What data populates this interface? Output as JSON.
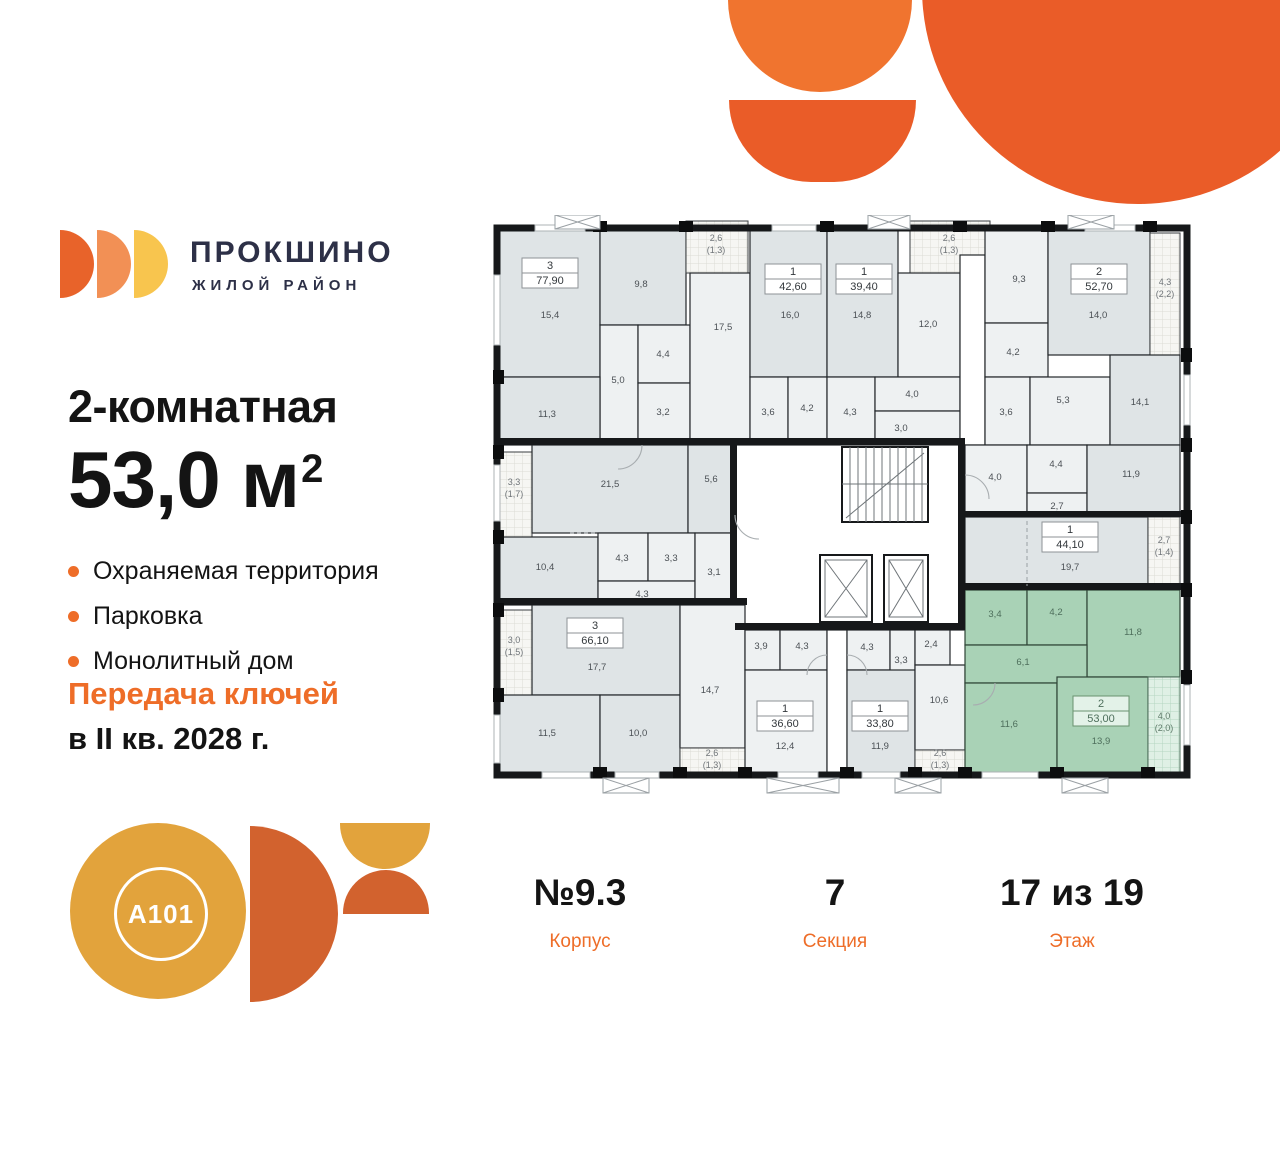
{
  "colors": {
    "orange": "#ea5c28",
    "orange_light": "#f0742f",
    "orange_mid": "#f29055",
    "yellow": "#f8c54e",
    "amber": "#e2a33c",
    "rust": "#d2622e",
    "navy": "#2d3047",
    "text_dark": "#141414",
    "accent": "#ee6d28",
    "room_green": "#a9d2b6",
    "room_gray": "#dfe4e6"
  },
  "brand": {
    "title": "ПРОКШИНО",
    "subtitle": "ЖИЛОЙ РАЙОН"
  },
  "offer": {
    "rooms_line": "2-комнатная",
    "area_value": "53,0 м",
    "area_sup": "2",
    "features": [
      "Охраняемая территория",
      "Парковка",
      "Монолитный дом"
    ],
    "keys_line1": "Передача ключей",
    "keys_line2": "в II кв. 2028 г."
  },
  "a101": {
    "logo_text": "A101"
  },
  "stats": [
    {
      "value": "№9.3",
      "label": "Корпус"
    },
    {
      "value": "7",
      "label": "Секция"
    },
    {
      "value": "17 из 19",
      "label": "Этаж"
    }
  ],
  "plan": {
    "highlighted_apartment": {
      "type": "2",
      "area": "53,00"
    },
    "apartments": [
      {
        "type": "3",
        "area": "77,90",
        "x": 60,
        "y": 58
      },
      {
        "type": "1",
        "area": "42,60",
        "x": 303,
        "y": 64
      },
      {
        "type": "1",
        "area": "39,40",
        "x": 374,
        "y": 64
      },
      {
        "type": "2",
        "area": "52,70",
        "x": 609,
        "y": 64
      },
      {
        "type": "1",
        "area": "44,10",
        "x": 580,
        "y": 322
      },
      {
        "type": "3",
        "area": "66,10",
        "x": 105,
        "y": 418
      },
      {
        "type": "1",
        "area": "36,60",
        "x": 295,
        "y": 501
      },
      {
        "type": "1",
        "area": "33,80",
        "x": 390,
        "y": 501
      },
      {
        "type": "2",
        "area": "53,00",
        "x": 611,
        "y": 496,
        "green": true
      }
    ],
    "room_labels": [
      {
        "t": "15,4",
        "x": 60,
        "y": 103
      },
      {
        "t": "9,8",
        "x": 151,
        "y": 72
      },
      {
        "t": "5,0",
        "x": 128,
        "y": 168
      },
      {
        "t": "4,4",
        "x": 173,
        "y": 142
      },
      {
        "t": "3,2",
        "x": 173,
        "y": 200
      },
      {
        "t": "11,3",
        "x": 57,
        "y": 202
      },
      {
        "t": "17,5",
        "x": 233,
        "y": 115
      },
      {
        "t": "16,0",
        "x": 300,
        "y": 103
      },
      {
        "t": "3,6",
        "x": 278,
        "y": 200
      },
      {
        "t": "4,2",
        "x": 317,
        "y": 196
      },
      {
        "t": "14,8",
        "x": 372,
        "y": 103
      },
      {
        "t": "12,0",
        "x": 438,
        "y": 112
      },
      {
        "t": "4,3",
        "x": 360,
        "y": 200
      },
      {
        "t": "4,0",
        "x": 422,
        "y": 182
      },
      {
        "t": "3,0",
        "x": 411,
        "y": 216
      },
      {
        "t": "9,3",
        "x": 529,
        "y": 67
      },
      {
        "t": "4,2",
        "x": 523,
        "y": 140
      },
      {
        "t": "14,0",
        "x": 608,
        "y": 103
      },
      {
        "t": "3,6",
        "x": 516,
        "y": 200
      },
      {
        "t": "5,3",
        "x": 573,
        "y": 188
      },
      {
        "t": "14,1",
        "x": 650,
        "y": 190
      },
      {
        "t": "21,5",
        "x": 120,
        "y": 272
      },
      {
        "t": "5,6",
        "x": 221,
        "y": 267
      },
      {
        "t": "10,4",
        "x": 55,
        "y": 355
      },
      {
        "t": "4,3",
        "x": 132,
        "y": 346
      },
      {
        "t": "3,3",
        "x": 181,
        "y": 346
      },
      {
        "t": "4,3",
        "x": 152,
        "y": 382
      },
      {
        "t": "3,1",
        "x": 224,
        "y": 360
      },
      {
        "t": "4,0",
        "x": 505,
        "y": 265
      },
      {
        "t": "4,4",
        "x": 566,
        "y": 252
      },
      {
        "t": "2,7",
        "x": 567,
        "y": 294
      },
      {
        "t": "11,9",
        "x": 641,
        "y": 262
      },
      {
        "t": "19,7",
        "x": 580,
        "y": 355
      },
      {
        "t": "17,7",
        "x": 107,
        "y": 455
      },
      {
        "t": "11,5",
        "x": 57,
        "y": 521
      },
      {
        "t": "10,0",
        "x": 148,
        "y": 521
      },
      {
        "t": "14,7",
        "x": 220,
        "y": 478
      },
      {
        "t": "3,9",
        "x": 271,
        "y": 434
      },
      {
        "t": "4,3",
        "x": 312,
        "y": 434
      },
      {
        "t": "12,4",
        "x": 295,
        "y": 534
      },
      {
        "t": "4,3",
        "x": 377,
        "y": 435
      },
      {
        "t": "3,3",
        "x": 411,
        "y": 448
      },
      {
        "t": "2,4",
        "x": 441,
        "y": 432
      },
      {
        "t": "10,6",
        "x": 449,
        "y": 488
      },
      {
        "t": "11,9",
        "x": 390,
        "y": 534
      },
      {
        "t": "3,4",
        "x": 505,
        "y": 402,
        "g": true
      },
      {
        "t": "4,2",
        "x": 566,
        "y": 400,
        "g": true
      },
      {
        "t": "11,8",
        "x": 643,
        "y": 420,
        "g": true
      },
      {
        "t": "6,1",
        "x": 533,
        "y": 450,
        "g": true
      },
      {
        "t": "11,6",
        "x": 519,
        "y": 512,
        "g": true
      },
      {
        "t": "13,9",
        "x": 611,
        "y": 529,
        "g": true
      }
    ],
    "balcony_labels": [
      {
        "l1": "2,6",
        "l2": "(1,3)",
        "x": 226,
        "y": 26
      },
      {
        "l1": "2,6",
        "l2": "(1,3)",
        "x": 459,
        "y": 26
      },
      {
        "l1": "4,3",
        "l2": "(2,2)",
        "x": 675,
        "y": 70
      },
      {
        "l1": "3,3",
        "l2": "(1,7)",
        "x": 24,
        "y": 270
      },
      {
        "l1": "2,7",
        "l2": "(1,4)",
        "x": 674,
        "y": 328
      },
      {
        "l1": "3,0",
        "l2": "(1,5)",
        "x": 24,
        "y": 428
      },
      {
        "l1": "2,6",
        "l2": "(1,3)",
        "x": 222,
        "y": 541
      },
      {
        "l1": "2,6",
        "l2": "(1,3)",
        "x": 450,
        "y": 541
      },
      {
        "l1": "4,0",
        "l2": "(2,0)",
        "x": 674,
        "y": 504,
        "g": true
      }
    ]
  }
}
